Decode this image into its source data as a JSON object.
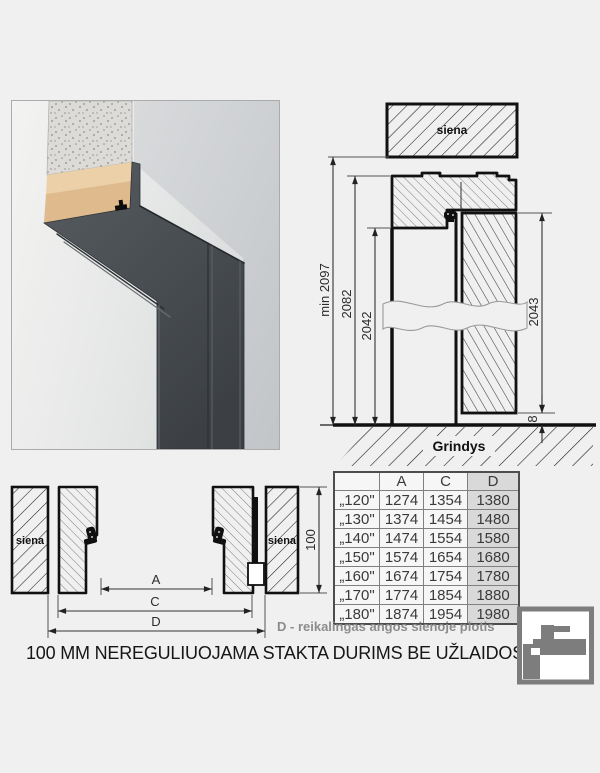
{
  "vertical_section": {
    "wall_label": "siena",
    "floor_label": "Grindys",
    "dim_min_height": "min 2097",
    "dim_frame_height": "2082",
    "dim_opening_height": "2042",
    "dim_door_height": "2043",
    "dim_floor_gap": "8"
  },
  "horizontal_section": {
    "wall_label_left": "siena",
    "wall_label_right": "siena",
    "dim_frame_depth": "100",
    "dim_a_label": "A",
    "dim_c_label": "C",
    "dim_d_label": "D"
  },
  "table": {
    "headers": [
      "",
      "A",
      "C",
      "D"
    ],
    "rows": [
      [
        "„120\"",
        "1274",
        "1354",
        "1380"
      ],
      [
        "„130\"",
        "1374",
        "1454",
        "1480"
      ],
      [
        "„140\"",
        "1474",
        "1554",
        "1580"
      ],
      [
        "„150\"",
        "1574",
        "1654",
        "1680"
      ],
      [
        "„160\"",
        "1674",
        "1754",
        "1780"
      ],
      [
        "„170\"",
        "1774",
        "1854",
        "1880"
      ],
      [
        "„180\"",
        "1874",
        "1954",
        "1980"
      ]
    ]
  },
  "captions": {
    "d_note": "D - reikalingas angos sienoje plotis",
    "title": "100 MM NEREGULIUOJAMA STAKTA DURIMS BE UŽLAIDOS"
  },
  "colors": {
    "note_gray": "#8c8c8c",
    "table_shade": "#d9d9d9",
    "frame_dark": "#474c50",
    "background": "#f0f0f1"
  }
}
